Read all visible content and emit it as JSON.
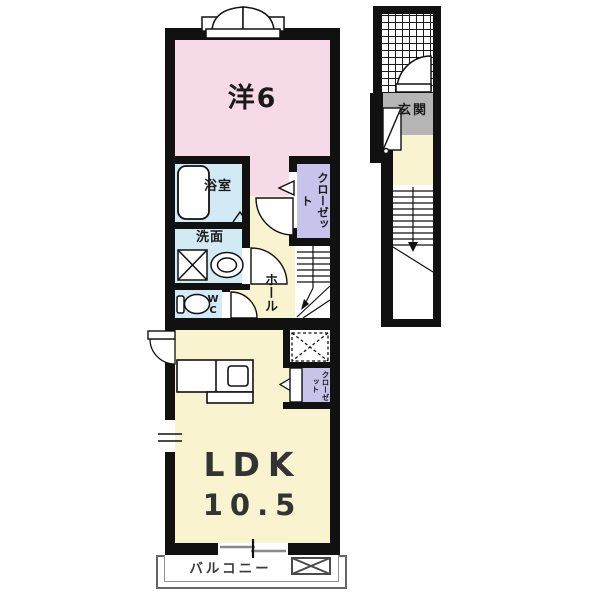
{
  "labels": {
    "western_room": "洋6",
    "bathroom": "浴室",
    "washroom": "洗面",
    "wc": "WC",
    "hall": "ホール",
    "closet": "クローゼット",
    "ldk_closet": "クローゼット",
    "ldk": "LDK",
    "ldk_size": "10.5",
    "balcony": "バルコニー",
    "entrance": "玄関"
  },
  "colors": {
    "wall": "#111111",
    "western_room": "#f7dae8",
    "wet_area": "#d2eaf4",
    "hall_ldk": "#faf3d0",
    "closet": "#c8c3ea",
    "entrance_gray": "#b5b5b5",
    "balcony_outline": "#666666",
    "background": "#ffffff"
  }
}
